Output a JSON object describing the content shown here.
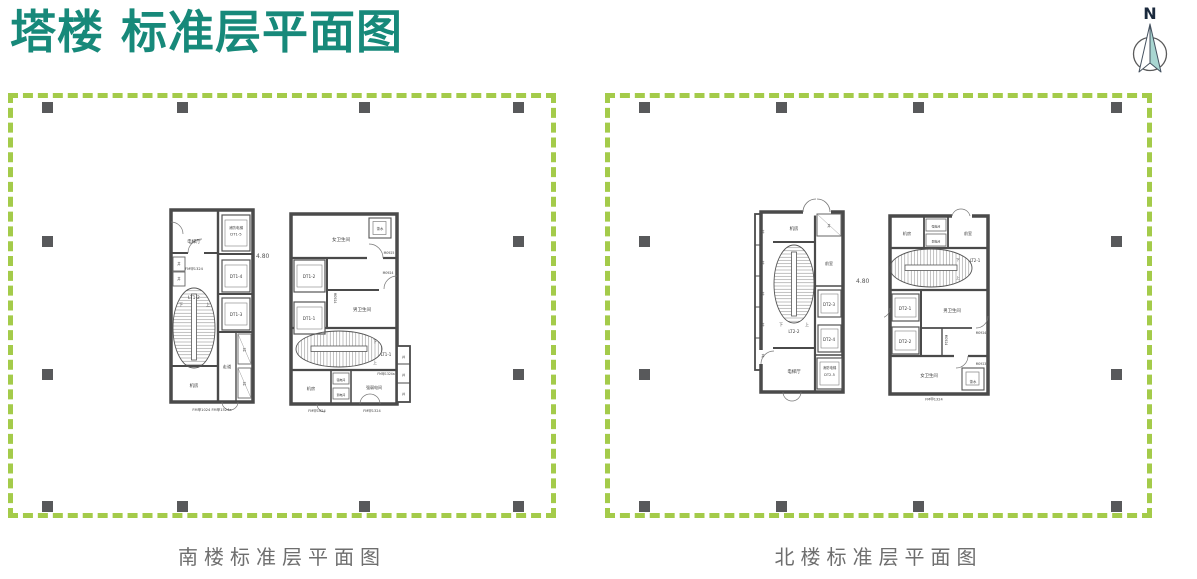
{
  "page": {
    "title": "塔楼 标准层平面图",
    "colors": {
      "title_teal": "#17897a",
      "dash_green": "#a4cb4a",
      "column_gray": "#58595b",
      "wall_gray": "#4a4a4a",
      "caption_gray": "#6e6e6e",
      "compass_fill": "#a9d6d1"
    }
  },
  "compass": {
    "label": "N"
  },
  "south": {
    "caption": "南楼标准层平面图",
    "level_mark": "4.80",
    "core_a": {
      "lobby": "电梯厅",
      "fire_lift_1": "消防电梯",
      "fire_lift_2": "DT1-5",
      "fm_top": "FM甲1324",
      "shaft_1": "井",
      "shaft_2": "井",
      "dt4": "DT1-4",
      "dt3": "DT1-3",
      "stair": "LT1-2",
      "up": "上",
      "down": "下",
      "corridor": "走道",
      "shaft_3": "井",
      "shaft_4": "井",
      "machine": "机房",
      "fm_bottom": "FM甲1024 FM甲1524a"
    },
    "core_b": {
      "women": "女卫生间",
      "tea": "茶水",
      "m0925": "M0925",
      "m0924_a": "M0924",
      "m0924_b": "M0924",
      "dt2": "DT1-2",
      "dt1": "DT1-1",
      "men": "男卫生间",
      "stair": "LT1-1",
      "up": "上",
      "down": "下",
      "fm_stair": "FM甲1324a",
      "machine": "机房",
      "strong": "强电间",
      "weak": "弱电间",
      "elec": "强弱电间",
      "fm_left": "FM甲1024",
      "fm_right": "FM甲1324",
      "shaft_1": "井",
      "shaft_2": "井",
      "shaft_3": "井"
    }
  },
  "north": {
    "caption": "北楼标准层平面图",
    "level_mark": "4.80",
    "core_a": {
      "machine": "机房",
      "shaft_1": "井",
      "shaft_2": "井",
      "shaft_3": "井",
      "shaft_4": "井",
      "shaft_5": "井",
      "shaft_6": "井",
      "front": "前室",
      "stair": "LT2-2",
      "up": "上",
      "down": "下",
      "dt3": "DT2-3",
      "dt4": "DT2-4",
      "fire_lift_1": "消防电梯",
      "fire_lift_2": "DT2-5",
      "lobby": "电梯厅"
    },
    "core_b": {
      "machine": "机房",
      "strong": "强电间",
      "weak": "弱电间",
      "front": "前室",
      "stair": "LT2-1",
      "up": "上",
      "down": "下",
      "dt1": "DT2-1",
      "dt2": "DT2-2",
      "men": "男卫生间",
      "m0924_a": "M0924",
      "m0924_b": "M0924",
      "m0923": "M0923",
      "women": "女卫生间",
      "tea": "茶水",
      "fm": "FM甲1324"
    }
  },
  "columns": {
    "south": [
      [
        47,
        107
      ],
      [
        182,
        107
      ],
      [
        364,
        107
      ],
      [
        518,
        107
      ],
      [
        47,
        241
      ],
      [
        518,
        241
      ],
      [
        47,
        374
      ],
      [
        518,
        374
      ],
      [
        47,
        506
      ],
      [
        182,
        506
      ],
      [
        364,
        506
      ],
      [
        518,
        506
      ]
    ],
    "north": [
      [
        644,
        107
      ],
      [
        781,
        107
      ],
      [
        918,
        107
      ],
      [
        1116,
        107
      ],
      [
        644,
        241
      ],
      [
        1116,
        241
      ],
      [
        644,
        374
      ],
      [
        1116,
        374
      ],
      [
        644,
        506
      ],
      [
        781,
        506
      ],
      [
        918,
        506
      ],
      [
        1116,
        506
      ]
    ]
  }
}
